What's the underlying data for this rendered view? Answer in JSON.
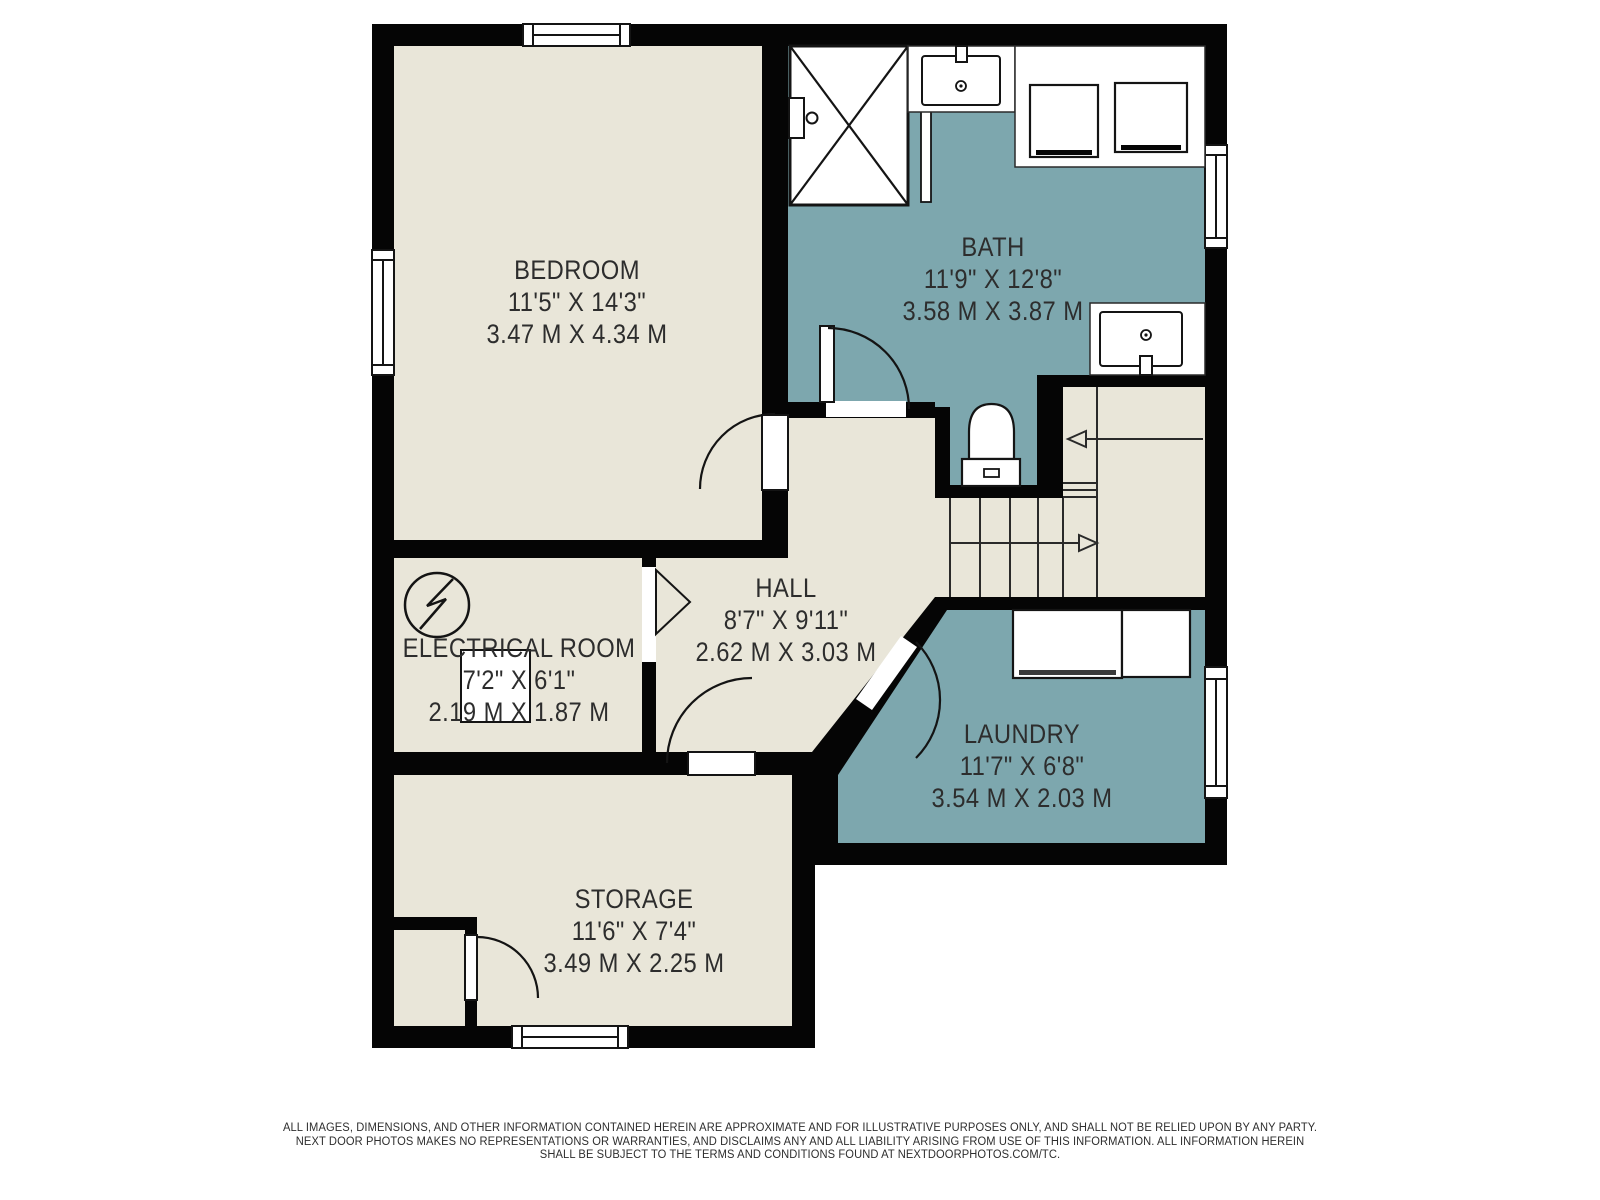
{
  "plan": {
    "title": "Basement floor plan",
    "colors": {
      "wall": "#050505",
      "room_beige": "#e9e6d9",
      "room_teal": "#7da7ae",
      "background": "#ffffff",
      "text": "#2d2d2d",
      "fixture_line": "#141414",
      "appliance_bar": "#3a3a3a"
    },
    "rooms": [
      {
        "id": "bedroom",
        "name": "BEDROOM",
        "dim_ft": "11'5\" X 14'3\"",
        "dim_m": "3.47 M X 4.34 M"
      },
      {
        "id": "bath",
        "name": "BATH",
        "dim_ft": "11'9\" X 12'8\"",
        "dim_m": "3.58 M X 3.87 M"
      },
      {
        "id": "hall",
        "name": "HALL",
        "dim_ft": "8'7\" X 9'11\"",
        "dim_m": "2.62 M X 3.03 M"
      },
      {
        "id": "electrical",
        "name": "ELECTRICAL ROOM",
        "dim_ft": "7'2\" X 6'1\"",
        "dim_m": "2.19 M X 1.87 M"
      },
      {
        "id": "laundry",
        "name": "LAUNDRY",
        "dim_ft": "11'7\" X 6'8\"",
        "dim_m": "3.54 M X 2.03 M"
      },
      {
        "id": "storage",
        "name": "STORAGE",
        "dim_ft": "11'6\" X 7'4\"",
        "dim_m": "3.49 M X 2.25 M"
      }
    ],
    "icons": [
      "shower-icon",
      "sink-icon",
      "toilet-icon",
      "stairs-icon",
      "stair-direction-arrow-icon",
      "electrical-symbol-icon",
      "electrical-panel-icon",
      "washer-icon",
      "dryer-icon",
      "cabinet-icon",
      "window-icon",
      "door-swing-icon"
    ],
    "disclaimer": {
      "line1": "ALL IMAGES, DIMENSIONS, AND OTHER INFORMATION CONTAINED HEREIN ARE APPROXIMATE AND FOR ILLUSTRATIVE PURPOSES ONLY, AND SHALL NOT BE RELIED UPON BY ANY PARTY.",
      "line2": "NEXT DOOR PHOTOS MAKES NO REPRESENTATIONS OR WARRANTIES, AND DISCLAIMS ANY AND ALL LIABILITY ARISING FROM USE OF THIS INFORMATION. ALL INFORMATION HEREIN",
      "line3": "SHALL BE SUBJECT TO THE TERMS AND CONDITIONS FOUND AT NEXTDOORPHOTOS.COM/TC."
    }
  }
}
